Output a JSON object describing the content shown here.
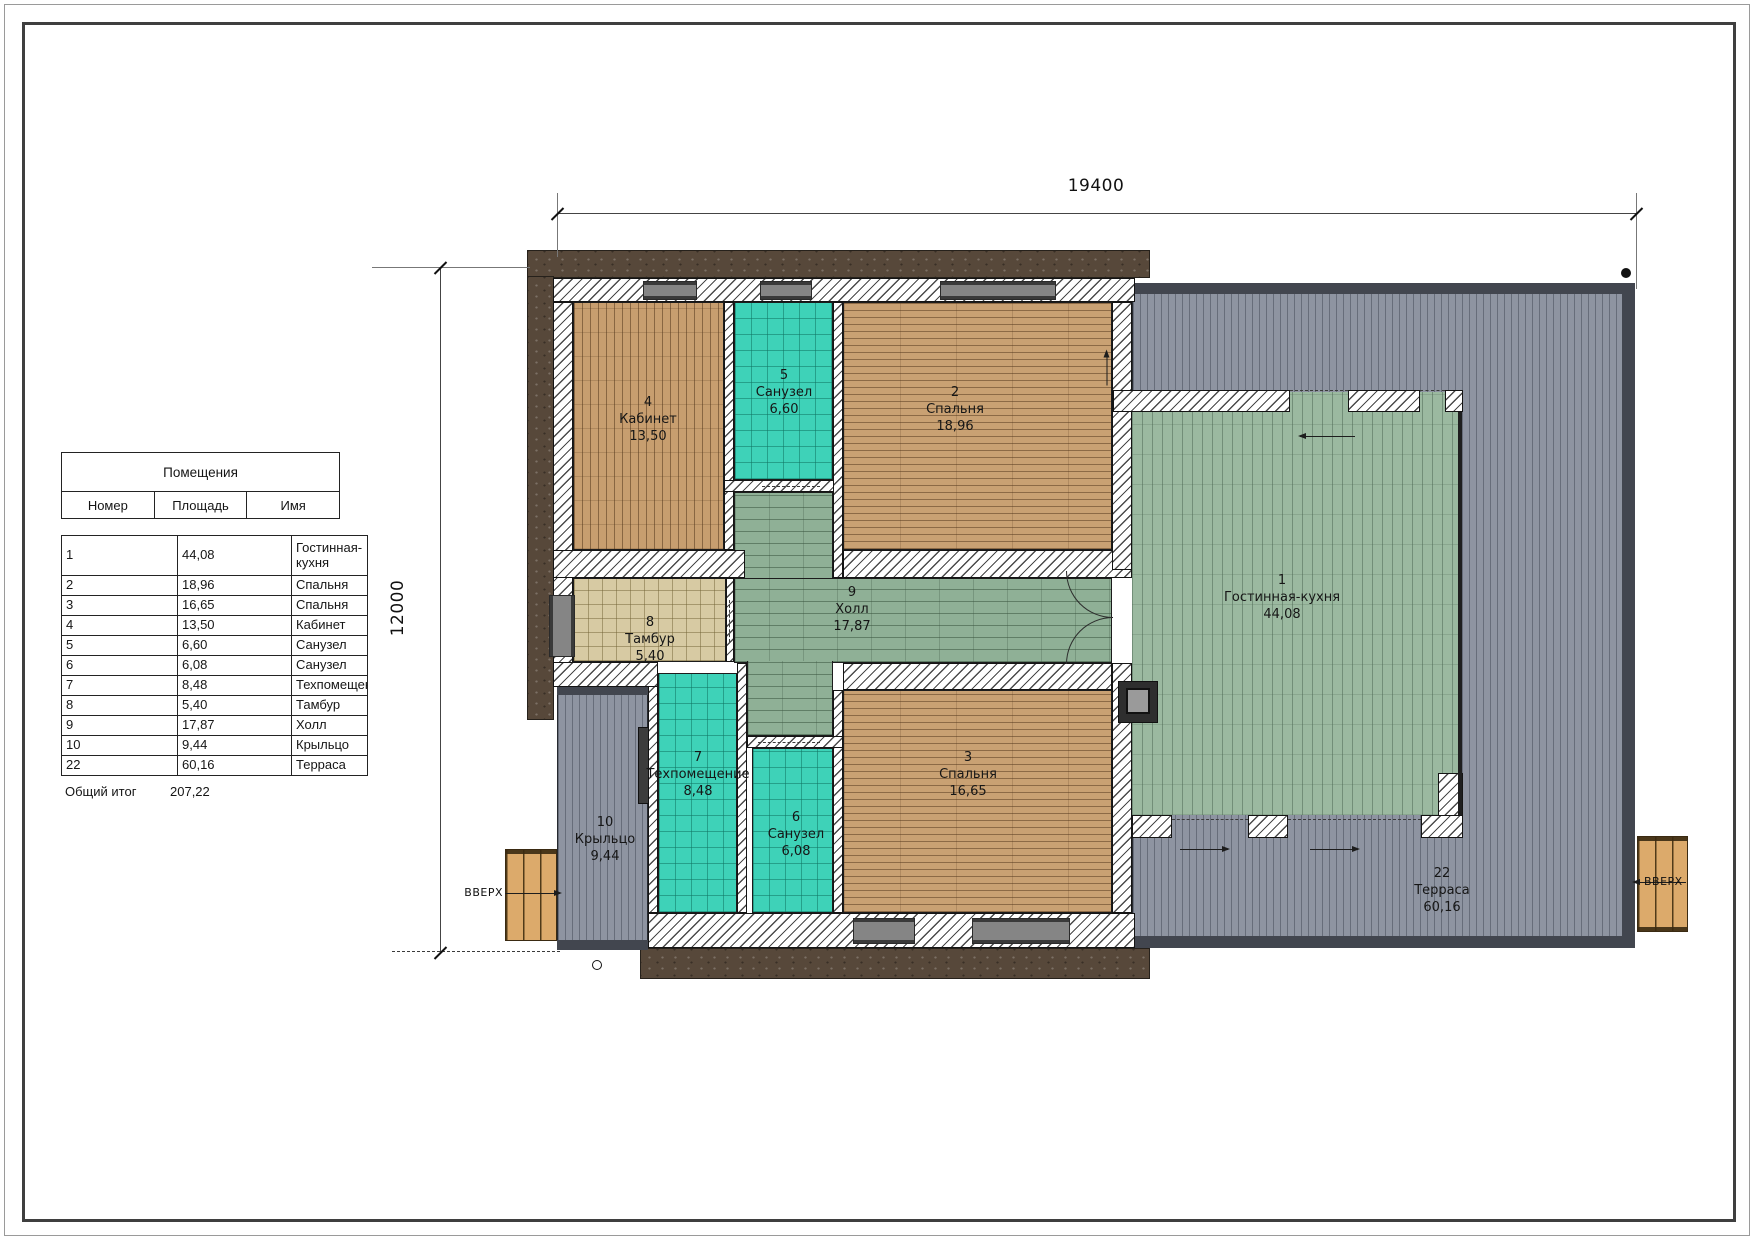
{
  "table": {
    "title": "Помещения",
    "columns": {
      "num": "Номер",
      "area": "Площадь",
      "name": "Имя"
    },
    "rows": [
      {
        "num": "1",
        "area": "44,08",
        "name": "Гостинная-кухня"
      },
      {
        "num": "2",
        "area": "18,96",
        "name": "Спальня"
      },
      {
        "num": "3",
        "area": "16,65",
        "name": "Спальня"
      },
      {
        "num": "4",
        "area": "13,50",
        "name": "Кабинет"
      },
      {
        "num": "5",
        "area": "6,60",
        "name": "Санузел"
      },
      {
        "num": "6",
        "area": "6,08",
        "name": "Санузел"
      },
      {
        "num": "7",
        "area": "8,48",
        "name": "Техпомещение"
      },
      {
        "num": "8",
        "area": "5,40",
        "name": "Тамбур"
      },
      {
        "num": "9",
        "area": "17,87",
        "name": "Холл"
      },
      {
        "num": "10",
        "area": "9,44",
        "name": "Крыльцо"
      },
      {
        "num": "22",
        "area": "60,16",
        "name": "Терраса"
      }
    ],
    "total_label": "Общий итог",
    "total_value": "207,22"
  },
  "dimensions": {
    "width_label": "19400",
    "height_label": "12000"
  },
  "stairs": {
    "label": "ВВЕРХ"
  },
  "colors": {
    "tile_teal": "#3ed2b8",
    "wood": "#c9a173",
    "hall_green": "#8fb096",
    "living_green": "#9bb9a0",
    "deck_gray": "#8e94a1",
    "deck_edge": "#42464f",
    "siding_brown": "#57483a",
    "tambour_beige": "#d7caa3",
    "stair_wood": "#dcaa6b"
  }
}
